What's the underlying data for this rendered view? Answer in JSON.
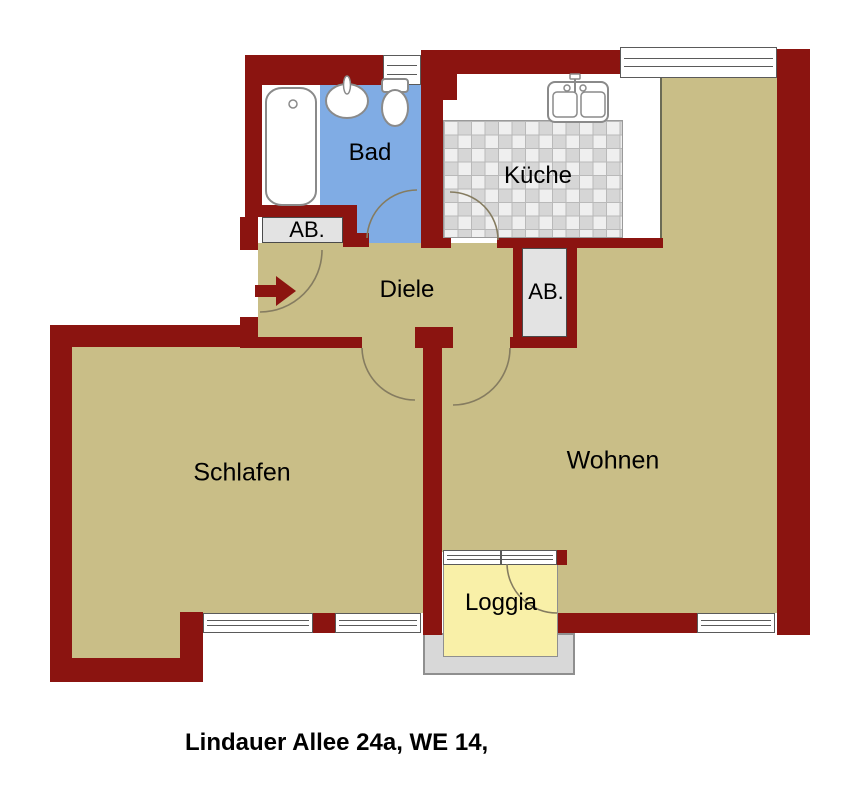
{
  "plan": {
    "caption": "Lindauer Allee 24a, WE 14,",
    "rooms": [
      {
        "id": "bad",
        "label": "Bad"
      },
      {
        "id": "kueche",
        "label": "Küche"
      },
      {
        "id": "ab-left",
        "label": "AB."
      },
      {
        "id": "diele",
        "label": "Diele"
      },
      {
        "id": "ab-right",
        "label": "AB."
      },
      {
        "id": "schlafen",
        "label": "Schlafen"
      },
      {
        "id": "wohnen",
        "label": "Wohnen"
      },
      {
        "id": "loggia",
        "label": "Loggia"
      }
    ],
    "fixtures": [
      "bathtub",
      "wash-basin",
      "toilet",
      "kitchen-double-sink"
    ],
    "symbols": {
      "entrance_arrow": "entrance-direction-arrow",
      "door_arcs": 6,
      "windows": 6
    },
    "colors": {
      "wall": "#8b1410",
      "floor_beige": "#c9be87",
      "bathroom_blue": "#80ace4",
      "loggia_yellow": "#f9f0a8",
      "closet_gray": "#e3e3e3",
      "balcony_gray": "#d8d8d8",
      "kitchen_tile_light": "#efefef",
      "kitchen_tile_dark": "#d6d6d6"
    }
  }
}
